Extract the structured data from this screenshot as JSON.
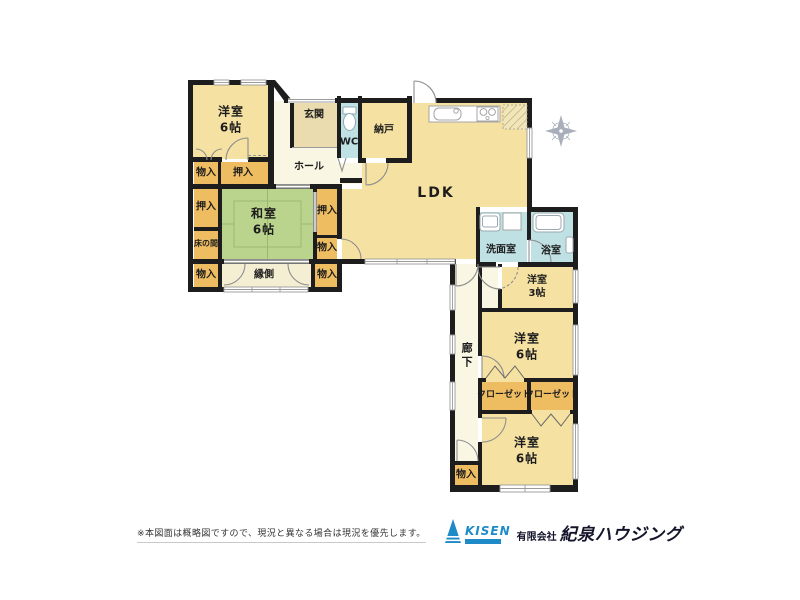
{
  "rooms": {
    "bedroom_nw": "洋室\n6帖",
    "genkan": "玄関",
    "wc": "WC",
    "nando": "納戸",
    "hall": "ホール",
    "storage_a": "物入",
    "oshiire_a": "押入",
    "oshiire_b": "押入",
    "tokonoma": "床の間",
    "washitsu": "和室\n6帖",
    "oshiire_c": "押入",
    "storage_b": "物入",
    "storage_c": "物入",
    "engawa": "縁側",
    "storage_d": "物入",
    "ldk": "LDK",
    "senmenshitsu": "洗面室",
    "yokushitsu": "浴室",
    "bedroom_e3": "洋室\n3帖",
    "bedroom_e6": "洋室\n6帖",
    "closet_a": "クローゼット",
    "closet_b": "クローゼット",
    "bedroom_s6": "洋室\n6帖",
    "rouka": "廊下",
    "storage_e": "物入"
  },
  "footer": {
    "disclaimer": "※本図面は概略図ですので、現況と異なる場合は現況を優先します。",
    "logo_text": "KISEN",
    "company_prefix": "有限会社",
    "company_name": "紀泉ハウジング"
  },
  "palette": {
    "room_yellow": "#f5e2a2",
    "genkan_beige": "#eadcae",
    "hall_cream": "#faf6e4",
    "engawa_cream": "#f4eed3",
    "closet_orange": "#eebd62",
    "tatami_green": "#bad38d",
    "wet_cyan": "#bfe1e4",
    "wall_black": "#1d1d1d",
    "brand_blue": "#1e8bc8",
    "brand_navy": "#14142a"
  }
}
